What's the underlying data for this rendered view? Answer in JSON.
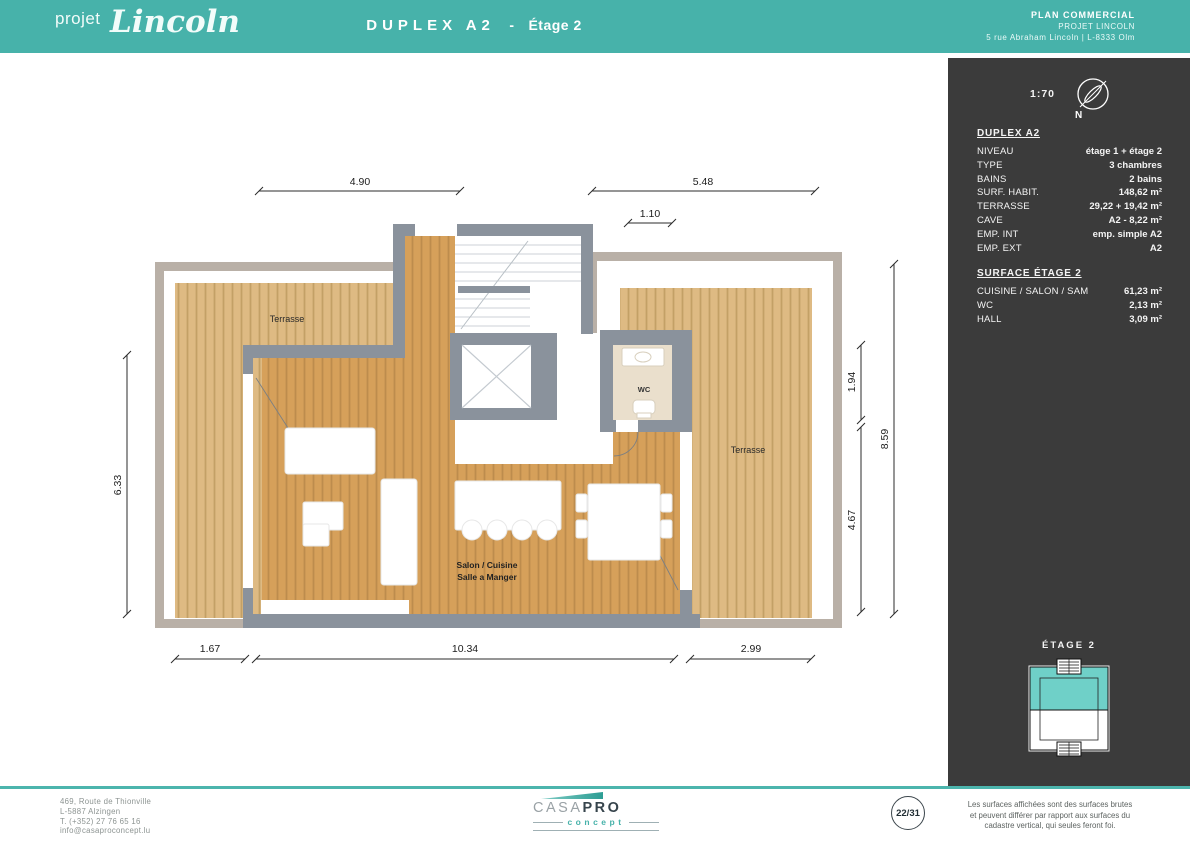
{
  "header": {
    "logo": {
      "prefix": "projet",
      "name": "Lincoln"
    },
    "title": {
      "main": "DUPLEX A2",
      "separator": "-",
      "sub": "Étage 2"
    },
    "doc_info": {
      "line1": "PLAN COMMERCIAL",
      "line2": "PROJET LINCOLN",
      "line3": "5 rue Abraham Lincoln | L-8333 Olm"
    }
  },
  "sidebar": {
    "scale": "1:70",
    "compass_label": "N",
    "unit_details": {
      "heading": "DUPLEX A2",
      "rows": [
        {
          "label": "NIVEAU",
          "value": "étage 1 + étage 2"
        },
        {
          "label": "TYPE",
          "value": "3 chambres"
        },
        {
          "label": "BAINS",
          "value": "2 bains"
        },
        {
          "label": "SURF. HABIT.",
          "value": "148,62 m²"
        },
        {
          "label": "TERRASSE",
          "value": "29,22 + 19,42 m²"
        },
        {
          "label": "CAVE",
          "value": "A2 - 8,22 m²"
        },
        {
          "label": "EMP. INT",
          "value": "emp. simple A2"
        },
        {
          "label": "EMP. EXT",
          "value": "A2"
        }
      ]
    },
    "surface_details": {
      "heading": "SURFACE ÉTAGE 2",
      "rows": [
        {
          "label": "CUISINE / SALON / SAM",
          "value": "61,23 m²"
        },
        {
          "label": "WC",
          "value": "2,13 m²"
        },
        {
          "label": "HALL",
          "value": "3,09 m²"
        }
      ]
    },
    "minimap": {
      "label": "ÉTAGE 2"
    }
  },
  "plan": {
    "labels": {
      "terrasse_left": "Terrasse",
      "terrasse_right": "Terrasse",
      "wc": "WC",
      "salon_line1": "Salon / Cuisine",
      "salon_line2": "Salle a Manger"
    },
    "dimensions": {
      "top_left": "4.90",
      "top_right": "5.48",
      "top_small": "1.10",
      "left": "6.33",
      "right_upper": "1.94",
      "right_lower": "4.67",
      "right_total": "8.59",
      "bottom_left": "1.67",
      "bottom_center": "10.34",
      "bottom_right": "2.99"
    }
  },
  "footer": {
    "address_lines": [
      "469, Route de Thionville",
      "L-5887 Alzingen",
      "T. (+352) 27 76 65 16",
      "info@casaproconcept.lu"
    ],
    "logo": {
      "casa": "CASA",
      "pro": "PRO",
      "concept": "concept"
    },
    "page_indicator": "22/31",
    "disclaimer_lines": [
      "Les surfaces affichées sont des surfaces brutes",
      "et peuvent différer par rapport aux surfaces du",
      "cadastre vertical, qui seules feront foi."
    ]
  },
  "colors": {
    "brand_teal": "#47b2aa",
    "sidebar_bg": "#3b3b3b",
    "wall_gray": "#8a929c",
    "wood_interior": "#d6a05a",
    "wood_terrace": "#deba83",
    "frame_tan": "#b9b0a7",
    "wc_floor": "#eadfcc",
    "minimap_teal": "#6fd0c8"
  }
}
